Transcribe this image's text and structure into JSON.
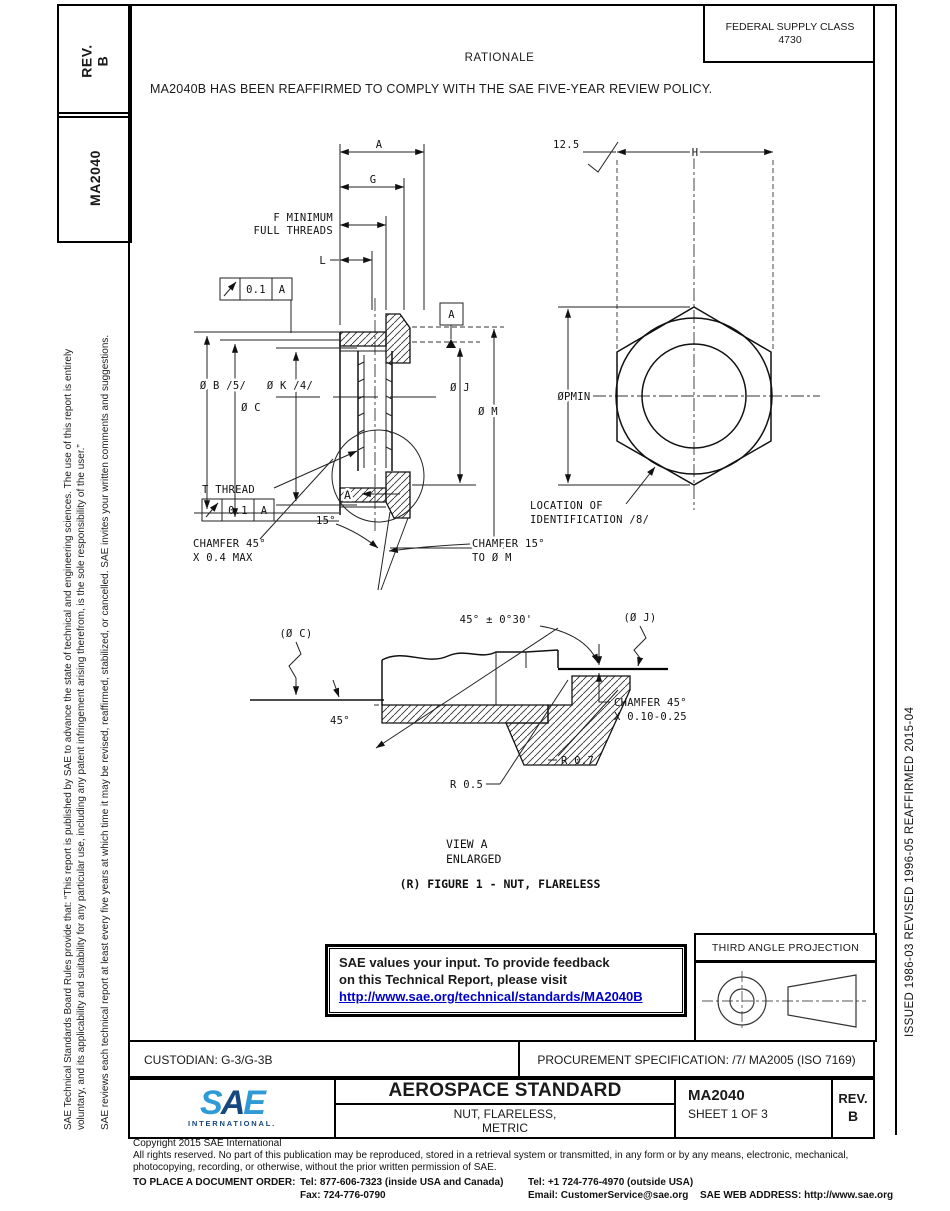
{
  "side": {
    "rev_title": "REV.",
    "rev_value": "B",
    "doc_number": "MA2040",
    "disclaimer_1a": "SAE Technical Standards Board Rules provide that: “This report is published by SAE to advance the state of technical and engineering sciences. The use of this report is entirely",
    "disclaimer_1b": "voluntary, and its applicability and suitability for any particular use, including any patent infringement arising therefrom, is the sole responsibility of the user.”",
    "disclaimer_2": "SAE reviews each technical report at least every five years at which time it may be revised, reaffirmed, stabilized, or cancelled. SAE invites your written comments and suggestions.",
    "history": "ISSUED 1986-03      REVISED 1996-05      REAFFIRMED 2015-04"
  },
  "header": {
    "fsc_label": "FEDERAL SUPPLY CLASS",
    "fsc_value": "4730",
    "rationale_title": "RATIONALE",
    "rationale_text": "MA2040B HAS BEEN REAFFIRMED TO COMPLY WITH THE SAE FIVE-YEAR REVIEW POLICY."
  },
  "drawing": {
    "dim_a": "A",
    "dim_g": "G",
    "f_min1": "F MINIMUM",
    "f_min2": "FULL THREADS",
    "dim_l": "L",
    "fcf_tol": "0.1",
    "fcf_datum": "A",
    "datum_flag": "A",
    "dia_b": "Ø B /5/",
    "dia_c": "Ø C",
    "dia_k": "Ø K /4/",
    "dia_j": "Ø J",
    "dia_m": "Ø M",
    "t_thread": "T THREAD",
    "angle_15": "15°",
    "ch45_1": "CHAMFER 45°",
    "ch45_2": "X 0.4 MAX",
    "ch15_1": "CHAMFER 15°",
    "ch15_2": "TO Ø M",
    "view_arrow_label": "A",
    "finish": "12.5",
    "dim_h": "H",
    "dia_p": "ØPMIN",
    "loc1": "LOCATION OF",
    "loc2": "IDENTIFICATION /8/",
    "va_c": "(Ø C)",
    "va_angle": "45° ± 0°30'",
    "va_j": "(Ø J)",
    "va_45": "45°",
    "va_ch1": "CHAMFER 45°",
    "va_ch2": "X 0.10-0.25",
    "va_r07": "R 0.7",
    "va_r05": "R 0.5",
    "view_a": "VIEW A",
    "enlarged": "ENLARGED",
    "caption": "(R)  FIGURE 1 - NUT, FLARELESS"
  },
  "feedback": {
    "line1": "SAE values your input. To provide feedback",
    "line2": "on this Technical Report, please visit",
    "link": "http://www.sae.org/technical/standards/MA2040B"
  },
  "projection": {
    "title": "THIRD ANGLE PROJECTION"
  },
  "footer": {
    "custodian": "CUSTODIAN: G-3/G-3B",
    "procurement": "PROCUREMENT SPECIFICATION: /7/ MA2005 (ISO 7169)",
    "logo_text": "SAE",
    "logo_sub": "INTERNATIONAL.",
    "doc_type": "AEROSPACE STANDARD",
    "title1": "NUT, FLARELESS,",
    "title2": "METRIC",
    "doc_number": "MA2040",
    "sheet": "SHEET 1 OF 3",
    "rev_label": "REV.",
    "rev_value": "B"
  },
  "legal": {
    "copyright": "Copyright 2015 SAE International",
    "rights": "All rights reserved. No part of this publication may be reproduced, stored in a retrieval system or transmitted, in any form or by any means, electronic, mechanical, photocopying, recording, or otherwise, without the prior written permission of SAE.",
    "order_label": "TO PLACE A DOCUMENT ORDER:",
    "tel_inside": "Tel: 877-606-7323 (inside USA and Canada)",
    "tel_outside": "Tel: +1 724-776-4970 (outside USA)",
    "fax": "Fax: 724-776-0790",
    "email": "Email: CustomerService@sae.org",
    "web": "SAE WEB ADDRESS: http://www.sae.org"
  },
  "colors": {
    "link_blue": "#0000cc",
    "sae_light_blue": "#2e9bd6",
    "sae_navy": "#16477e"
  }
}
